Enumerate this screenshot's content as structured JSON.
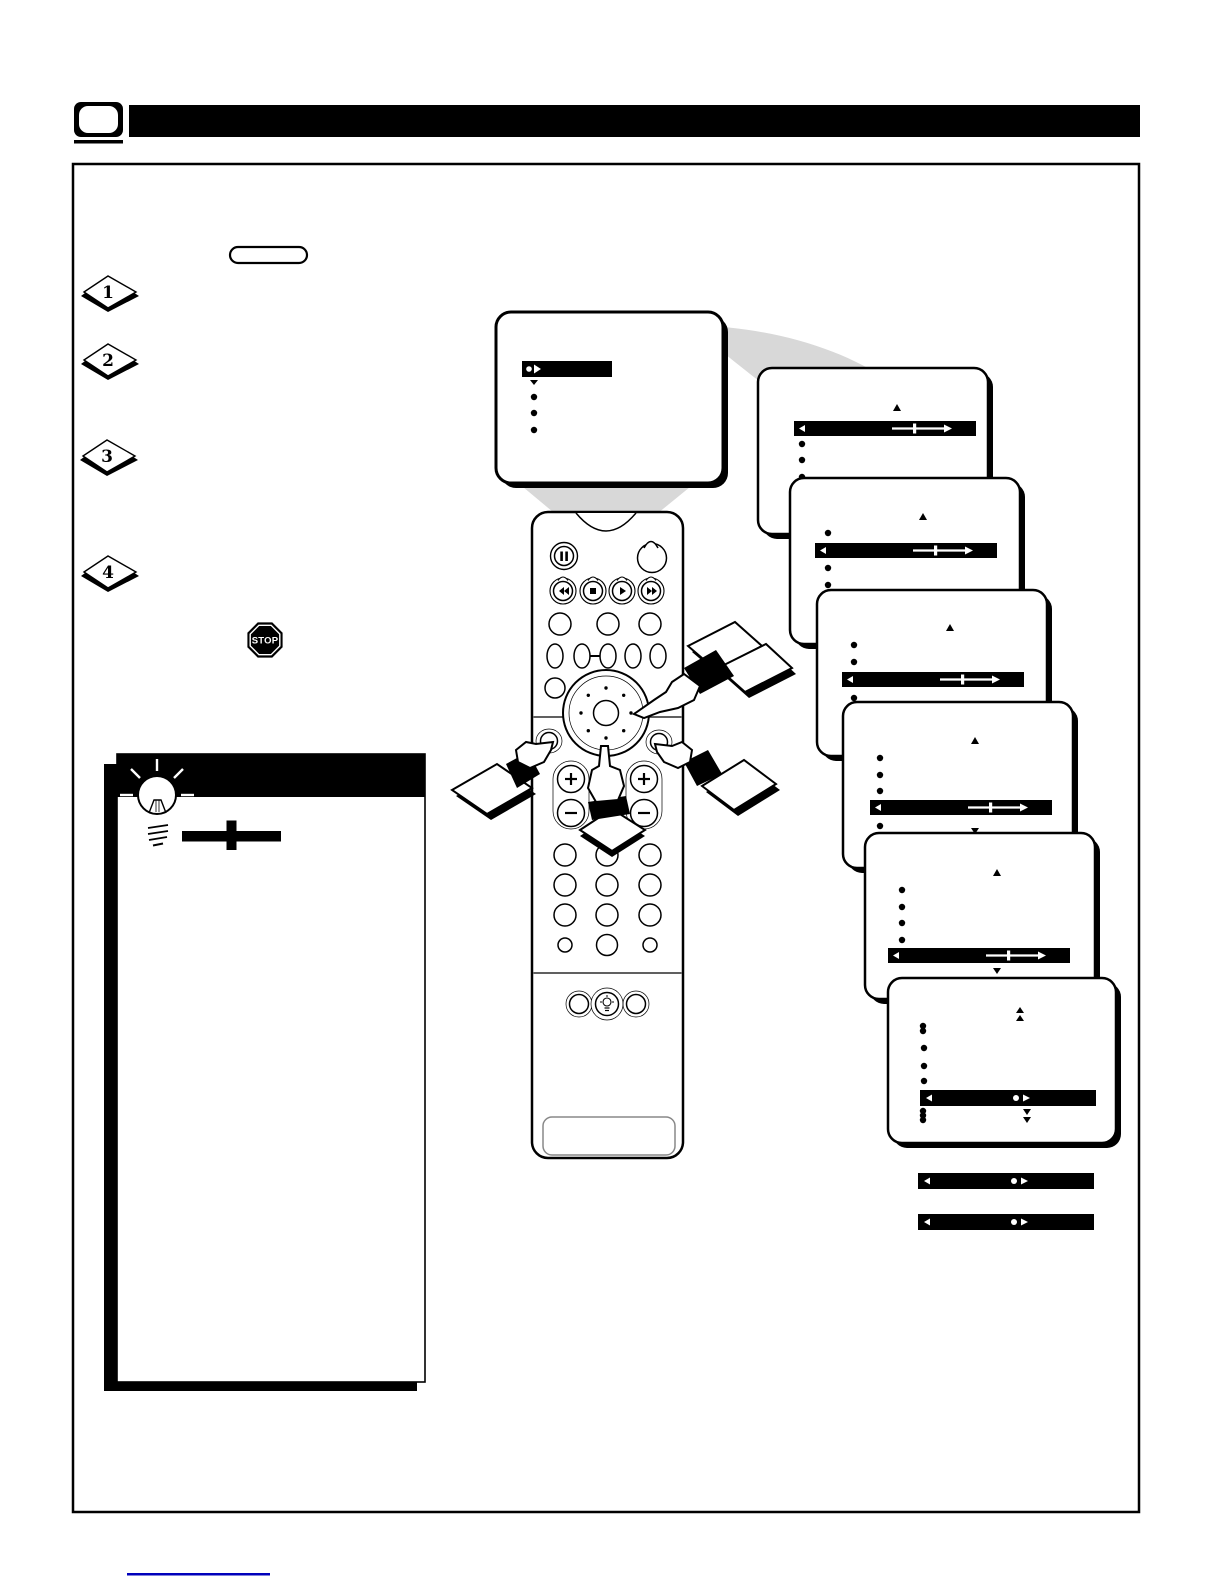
{
  "steps": [
    {
      "number": "1"
    },
    {
      "number": "2"
    },
    {
      "number": "3"
    },
    {
      "number": "4"
    }
  ],
  "stop": {
    "label": "STOP"
  },
  "colors": {
    "ink": "#000000",
    "beam_gray": "#d8d8d8",
    "link_line_blue": "#0000bb",
    "battery_outline_gray": "#888888"
  }
}
